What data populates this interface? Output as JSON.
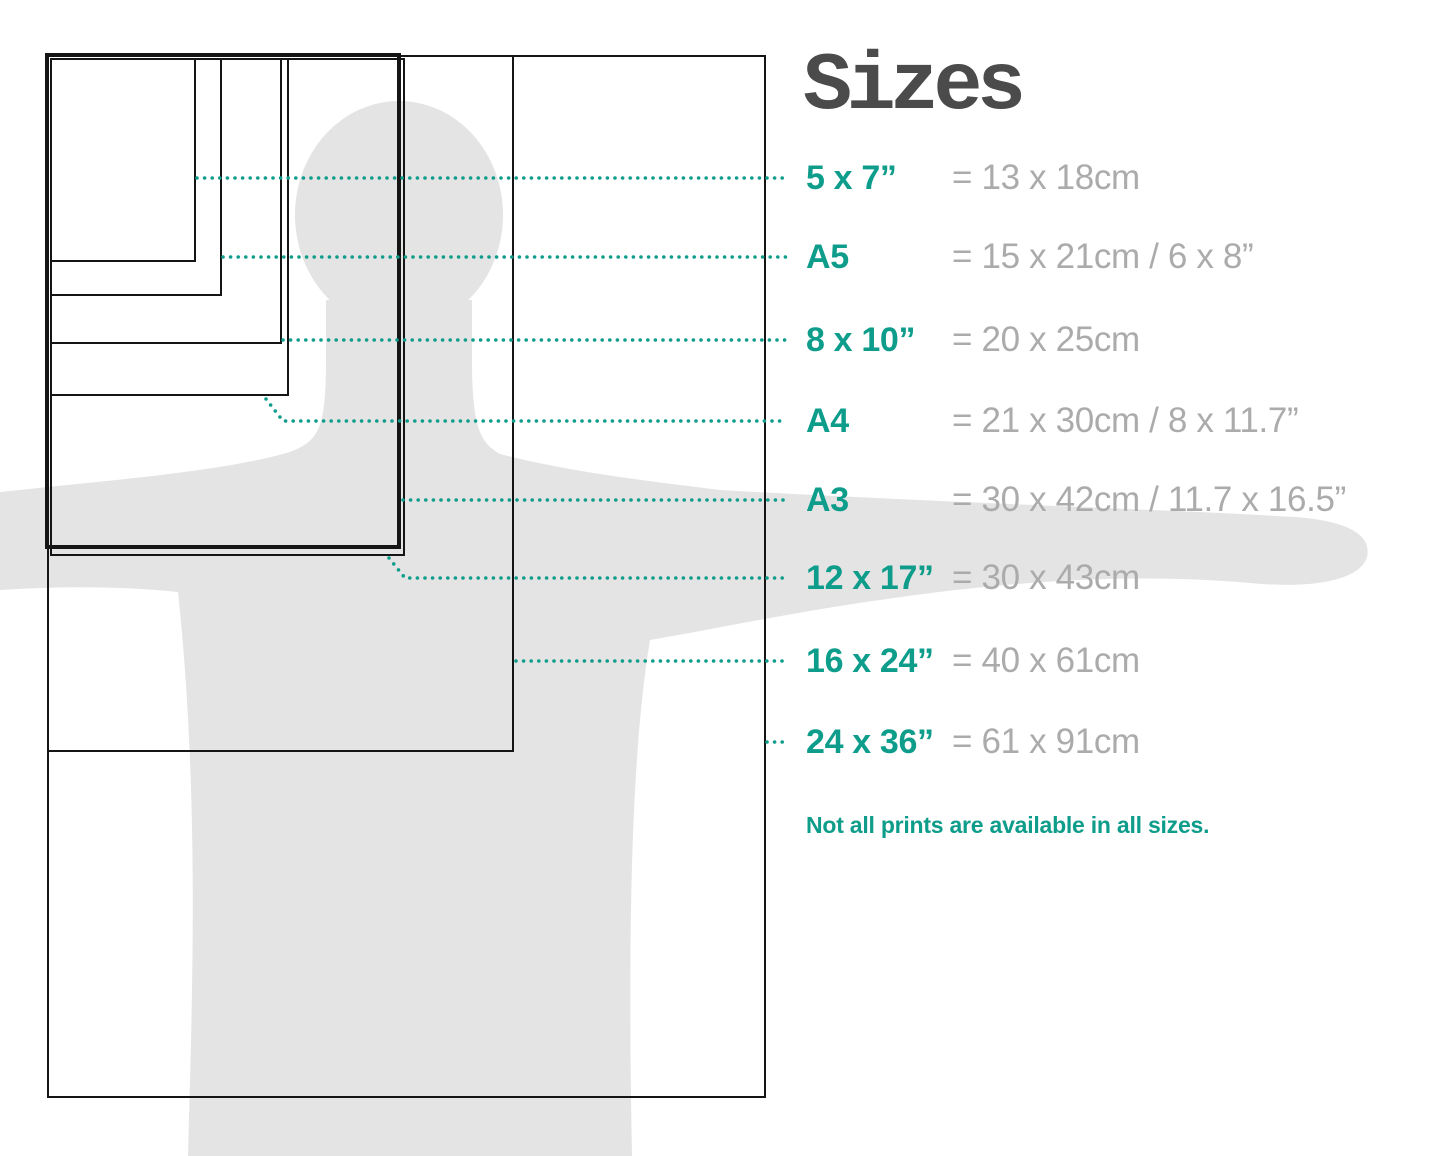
{
  "title": "Sizes",
  "note": "Not all prints are available in all sizes.",
  "colors": {
    "accent": "#0e9c8b",
    "muted": "#ababab",
    "title": "#4b4b4b",
    "silhouette": "#e4e4e4",
    "outline": "#151515",
    "bg": "#ffffff"
  },
  "sizes": [
    {
      "label": "5 x 7”",
      "value": "= 13 x 18cm"
    },
    {
      "label": "A5",
      "value": "= 15 x 21cm / 6 x 8”"
    },
    {
      "label": "8 x 10”",
      "value": "= 20 x 25cm"
    },
    {
      "label": "A4",
      "value": "= 21 x 30cm / 8 x 11.7”"
    },
    {
      "label": "A3",
      "value": "= 30 x 42cm / 11.7 x 16.5”"
    },
    {
      "label": "12 x 17”",
      "value": "= 30 x 43cm"
    },
    {
      "label": "16 x 24”",
      "value": "= 40 x 61cm"
    },
    {
      "label": "24 x 36”",
      "value": "= 61 x 91cm"
    }
  ]
}
